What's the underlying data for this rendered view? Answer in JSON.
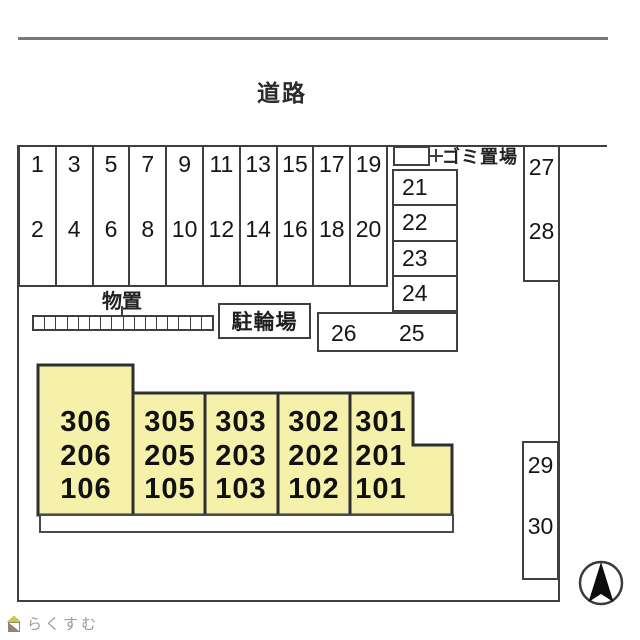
{
  "road": {
    "label": "道路"
  },
  "parking": {
    "columns": [
      [
        "1",
        "2"
      ],
      [
        "3",
        "4"
      ],
      [
        "5",
        "6"
      ],
      [
        "7",
        "8"
      ],
      [
        "9",
        "10"
      ],
      [
        "11",
        "12"
      ],
      [
        "13",
        "14"
      ],
      [
        "15",
        "16"
      ],
      [
        "17",
        "18"
      ],
      [
        "19",
        "20"
      ]
    ],
    "stack": [
      "21",
      "22",
      "23",
      "24"
    ],
    "row": [
      "26",
      "25"
    ],
    "upper_right": [
      "27",
      "28"
    ],
    "lower_right": [
      "29",
      "30"
    ]
  },
  "facilities": {
    "garbage_label": "ゴミ置場",
    "storage_label": "物置",
    "storage_cell_count": 16,
    "bicycle_label": "駐輪場"
  },
  "building": {
    "units": [
      [
        "306",
        "206",
        "106"
      ],
      [
        "305",
        "205",
        "105"
      ],
      [
        "303",
        "203",
        "103"
      ],
      [
        "302",
        "202",
        "102"
      ],
      [
        "301",
        "201",
        "101"
      ]
    ],
    "fill_color": "#f5f1aa",
    "stroke_color": "#2f2f2f"
  },
  "logo": {
    "text": "らくすむ"
  },
  "colors": {
    "plan_line": "#3f3f3f",
    "road_line": "#7a7a7a",
    "logo_text": "#a5968a",
    "logo_roof": "#c6cb4d",
    "logo_body": "#93836f"
  }
}
